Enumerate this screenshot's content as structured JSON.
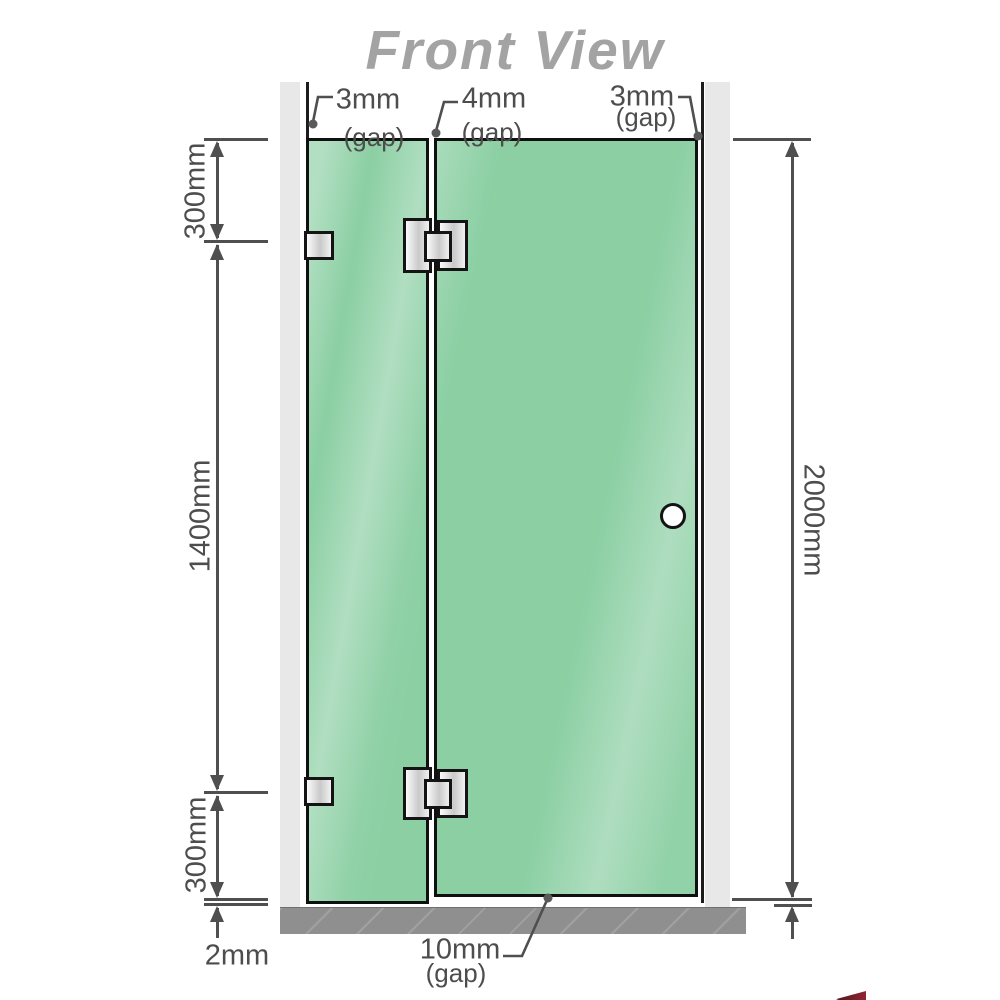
{
  "title": "Front View",
  "labels": {
    "gap_left": {
      "value": "3mm",
      "note": "(gap)"
    },
    "gap_middle": {
      "value": "4mm",
      "note": "(gap)"
    },
    "gap_right": {
      "value": "3mm",
      "note": "(gap)"
    },
    "gap_bottom": {
      "value": "10mm",
      "note": "(gap)"
    },
    "dim_left_top": "300mm",
    "dim_left_middle": "1400mm",
    "dim_left_bottom": "300mm",
    "dim_bottom_left": "2mm",
    "dim_right": "2000mm"
  },
  "colors": {
    "glass": "#8bcfa3",
    "glass_highlight": "#c3e8d2",
    "wall_channel": "#e8e8e8",
    "wall_line": "#1c1c1c",
    "floor": "#8f8f8f",
    "dimension": "#4f4f4f",
    "text": "#4d4d4d",
    "title": "#a3a3a3",
    "hardware_border": "#141414",
    "logo_accent": "#8c1122"
  }
}
